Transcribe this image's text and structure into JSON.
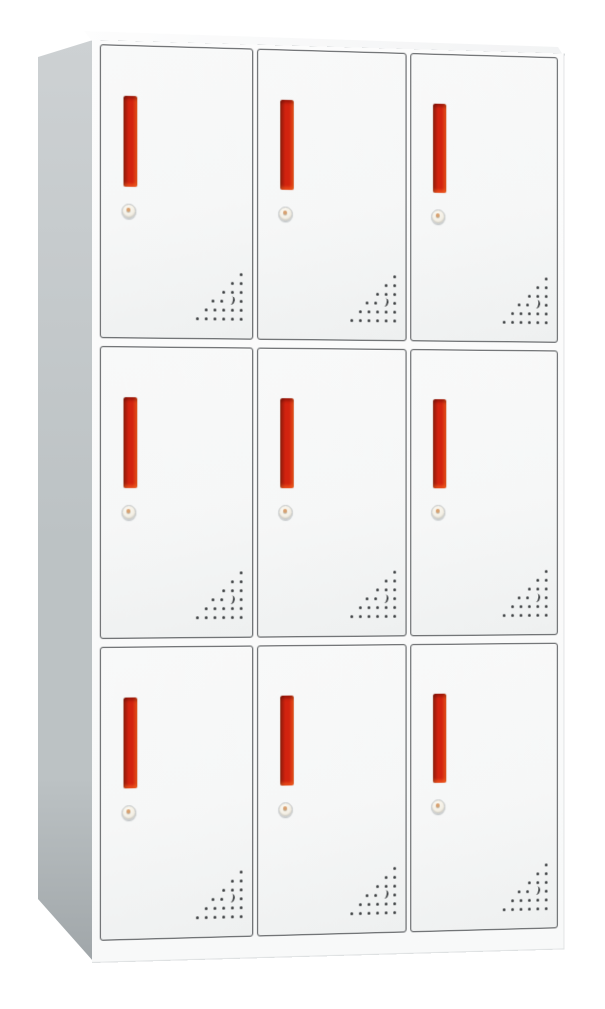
{
  "scene": {
    "type": "product-photo",
    "subject": "nine-door steel storage locker cabinet",
    "view": "front three-quarter view from the left, slightly above",
    "background": "plain white",
    "visible_faces": [
      "front",
      "left-side",
      "top"
    ]
  },
  "cabinet": {
    "rows": 3,
    "columns": 3,
    "door_count": 9,
    "door_components": {
      "handle": "vertical recessed red pull handle",
      "lock": "round cam keyhole lock below handle",
      "vents": "triangular grid of punched ventilation holes at bottom-right of each door"
    },
    "vent": {
      "rows": 6,
      "bottom_row_holes": 6,
      "accent_row": 3,
      "accent": "crescent-shaped larger hole near middle of triangle"
    },
    "base": "recessed white plinth under doors"
  },
  "colors": {
    "background": "#ffffff",
    "side_gray_light": "#cdd1d3",
    "side_gray_mid": "#bcc2c4",
    "side_gray_dark": "#a0a6a9",
    "top_face_light": "#fdfdfd",
    "top_face_dark": "#f2f3f4",
    "top_edge": "#9ba1a4",
    "front_white": "#fcfcfc",
    "door_fill": "#f6f7f7",
    "door_fill_dark": "#eef0f0",
    "door_border": "#46494c",
    "handle_red": "#d2230f",
    "handle_dark": "#7c150b",
    "handle_highlight": "#ef5a22",
    "lock_face": "#f4f0e6",
    "lock_ring": "#c2c5c6",
    "lock_pin": "#d8a06e",
    "vent_dot": "#3a3d3f"
  }
}
